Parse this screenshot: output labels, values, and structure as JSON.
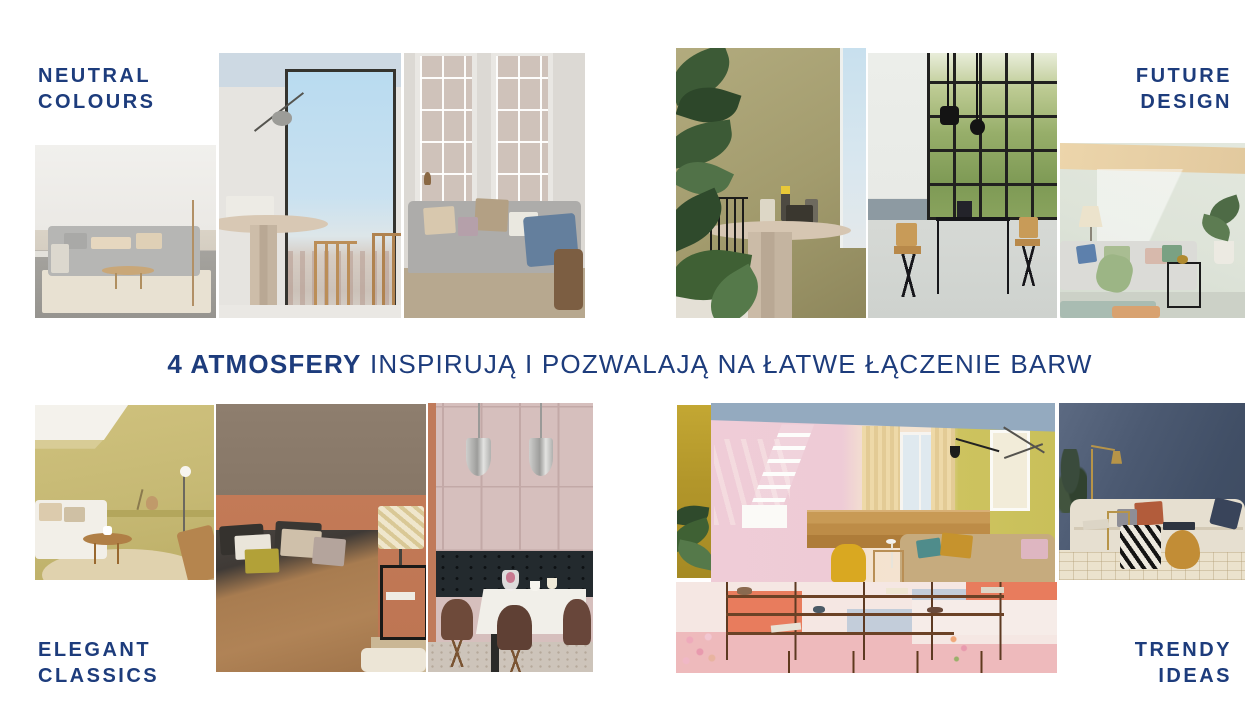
{
  "slide": {
    "headline": {
      "bold": "4 ATMOSFERY",
      "rest": "INSPIRUJĄ I POZWALAJĄ NA ŁATWE ŁĄCZENIE BARW"
    },
    "atmospheres": [
      {
        "id": "neutral-colours",
        "line1": "NEUTRAL",
        "line2": "COLOURS",
        "label_position": "top-left"
      },
      {
        "id": "future-design",
        "line1": "FUTURE",
        "line2": "DESIGN",
        "label_position": "top-right"
      },
      {
        "id": "elegant-classics",
        "line1": "ELEGANT",
        "line2": "CLASSICS",
        "label_position": "bottom-left"
      },
      {
        "id": "trendy-ideas",
        "line1": "TRENDY",
        "line2": "IDEAS",
        "label_position": "bottom-right"
      }
    ],
    "colors": {
      "label_navy": "#1d3c7c",
      "background": "#ffffff",
      "neutral_palette": [
        "#eceae6",
        "#b6b6b4",
        "#cdd9e3",
        "#d8c8b4"
      ],
      "future_palette": [
        "#9d9668",
        "#7e9a55",
        "#16161a",
        "#dde3d8"
      ],
      "elegant_palette": [
        "#c6b974",
        "#8e7e6e",
        "#c37a57",
        "#d6bfbd"
      ],
      "trendy_palette": [
        "#efccd7",
        "#c9c05a",
        "#e87c5d",
        "#c3cdda",
        "#44536b"
      ]
    }
  }
}
